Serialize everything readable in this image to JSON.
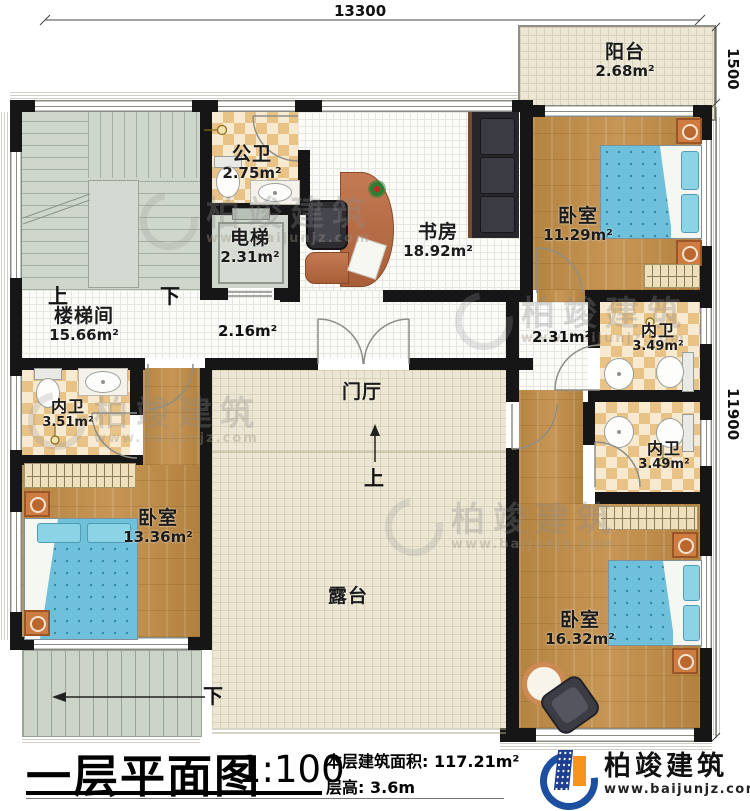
{
  "dimensions": {
    "top": "13300",
    "right_upper": "1500",
    "right_lower": "11900"
  },
  "rooms": {
    "balcony": {
      "name": "阳台",
      "area": "2.68m²"
    },
    "public_bath": {
      "name": "公卫",
      "area": "2.75m²"
    },
    "elevator": {
      "name": "电梯",
      "area": "2.31m²"
    },
    "study": {
      "name": "书房",
      "area": "18.92m²"
    },
    "bedroom_ne": {
      "name": "卧室",
      "area": "11.29m²"
    },
    "stairwell": {
      "name": "楼梯间",
      "area": "15.66m²"
    },
    "corridor": {
      "area": "2.16m²"
    },
    "corridor_e": {
      "area": "2.31m²"
    },
    "bath_ne": {
      "name": "内卫",
      "area": "3.49m²"
    },
    "bath_se": {
      "name": "内卫",
      "area": "3.49m²"
    },
    "bath_w": {
      "name": "内卫",
      "area": "3.51m²"
    },
    "foyer": {
      "name": "门厅"
    },
    "bedroom_sw": {
      "name": "卧室",
      "area": "13.36m²"
    },
    "terrace": {
      "name": "露台"
    },
    "bedroom_se": {
      "name": "卧室",
      "area": "16.32m²"
    }
  },
  "stairs": {
    "up": "上",
    "down": "下",
    "ext_down": "下",
    "terrace_up": "上"
  },
  "titleblock": {
    "title": "一层平面图",
    "scale": "1:100",
    "area_label": "本层建筑面积:",
    "area_value": "117.21m²",
    "height_label": "层高:",
    "height_value": "3.6m"
  },
  "brand": {
    "name": "柏竣建筑",
    "url": "www.baijunjz.com"
  },
  "watermark": {
    "name": "柏竣建筑",
    "url": "www.baijunjz.com"
  },
  "colors": {
    "wall": "#161616",
    "wood": "#bb8a46",
    "bed_blue": "#6fc0da",
    "checker": "#e9c386",
    "logo_blue": "#1c4fa0",
    "logo_orange": "#f7941d"
  }
}
